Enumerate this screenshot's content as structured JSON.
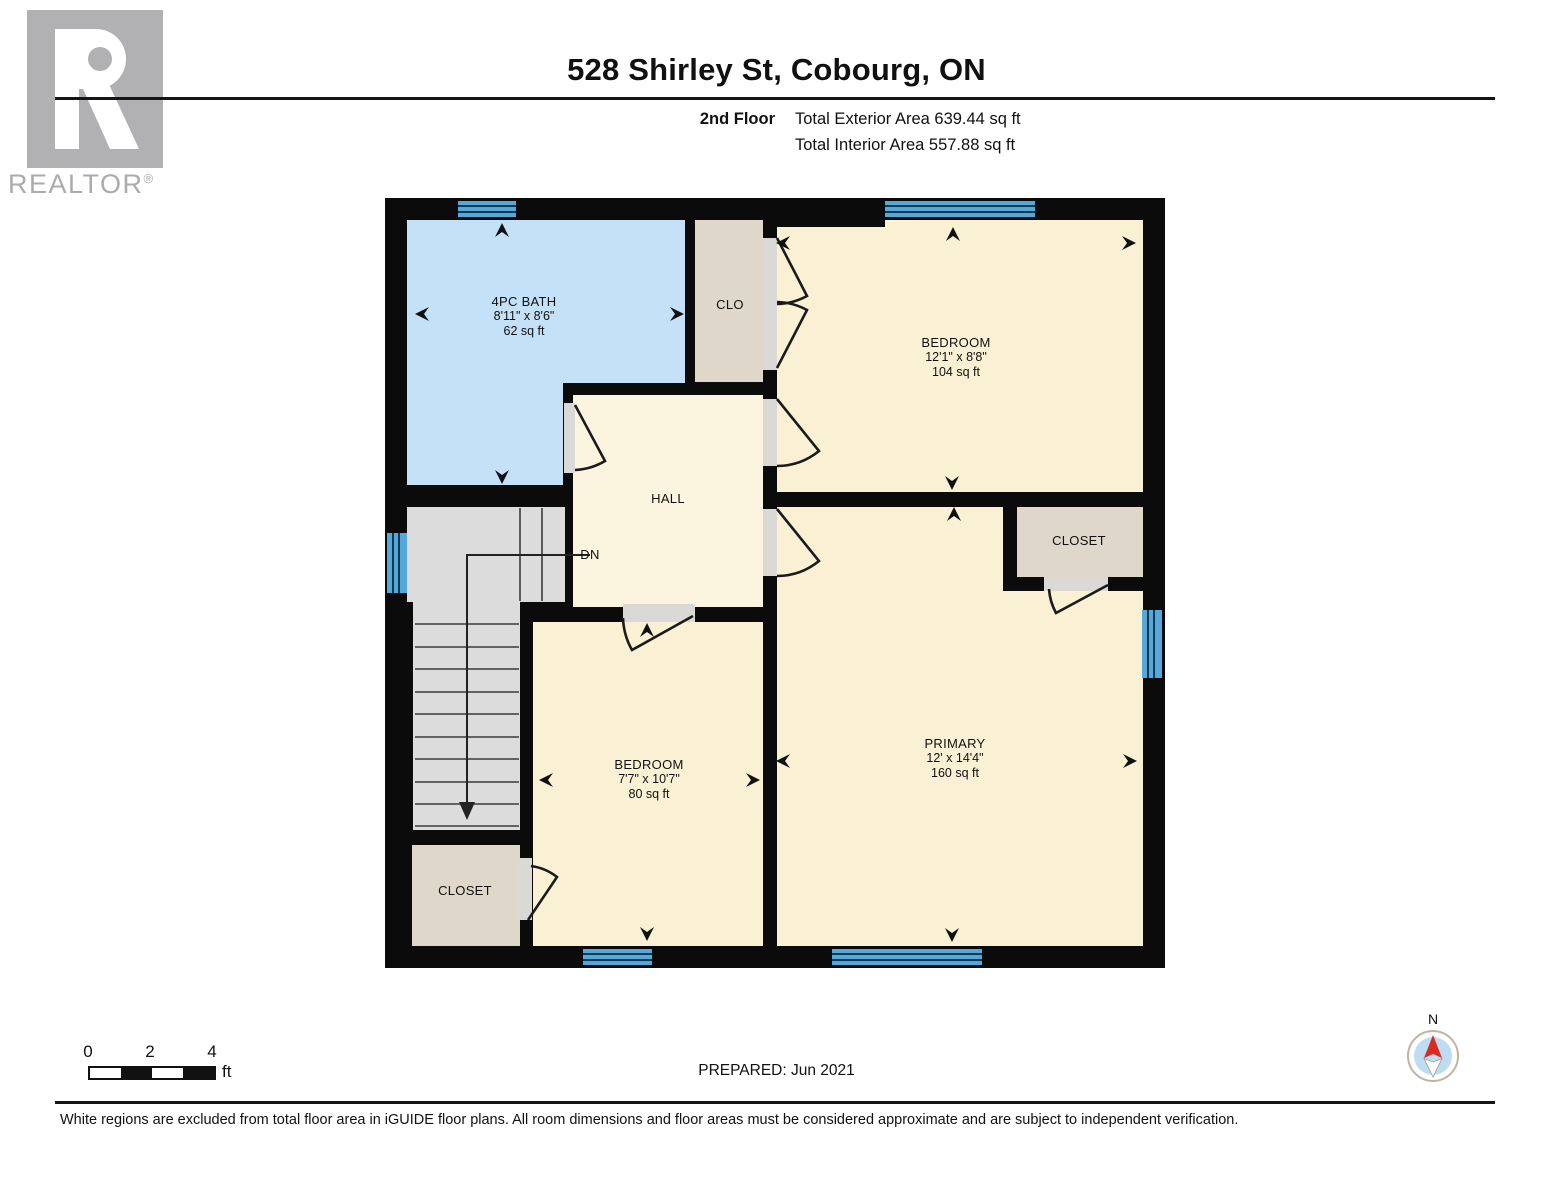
{
  "header": {
    "title": "528 Shirley St, Cobourg, ON",
    "floor": "2nd Floor",
    "exterior": "Total Exterior Area 639.44 sq ft",
    "interior": "Total Interior Area 557.88 sq ft",
    "logo_text": "REALTOR",
    "logo_reg": "®"
  },
  "rooms": {
    "bath": {
      "name": "4PC BATH",
      "dims": "8'11\" x 8'6\"",
      "area": "62 sq ft"
    },
    "clo": {
      "name": "CLO"
    },
    "bedroom_top": {
      "name": "BEDROOM",
      "dims": "12'1\" x 8'8\"",
      "area": "104 sq ft"
    },
    "hall": {
      "name": "HALL"
    },
    "stairs": {
      "label": "DN"
    },
    "closet_right": {
      "name": "CLOSET"
    },
    "primary": {
      "name": "PRIMARY",
      "dims": "12' x 14'4\"",
      "area": "160 sq ft"
    },
    "bedroom_bottom": {
      "name": "BEDROOM",
      "dims": "7'7\" x 10'7\"",
      "area": "80 sq ft"
    },
    "closet_bottom_left": {
      "name": "CLOSET"
    }
  },
  "footer": {
    "scale_ticks": [
      "0",
      "2",
      "4"
    ],
    "scale_unit": "ft",
    "prepared": "PREPARED: Jun 2021",
    "disclaimer": "White regions are excluded from total floor area in iGUIDE floor plans. All room dimensions and floor areas must be considered approximate and are subject to independent verification.",
    "compass_n": "N"
  },
  "colors": {
    "wall": "#0b0b0b",
    "room_cream": "#FAF0D3",
    "hall_cream": "#FBF4DE",
    "bath_blue": "#C5E1F7",
    "closet_tan": "#DFD7CA",
    "stairs_gray": "#DCDCDC",
    "window_blue": "#55A9DA",
    "threshold_gray": "#DAD9D6",
    "logo_gray": "#B1B1B4"
  }
}
